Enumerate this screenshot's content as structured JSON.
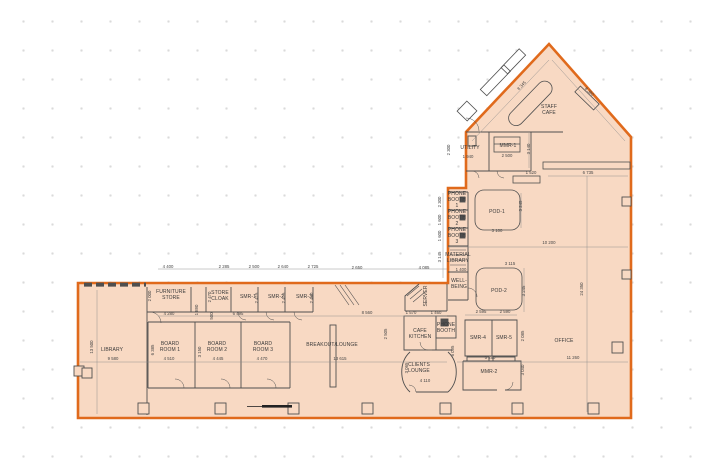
{
  "plan": {
    "title": "office-fitout-floor-plan",
    "colors": {
      "outer_wall": "#e06a1c",
      "floor_fill": "#f8d9c3",
      "partition_line": "#4f4f4f",
      "dim_text": "#474747",
      "grid_dot": "#dadada",
      "background": "#ffffff"
    },
    "rooms": {
      "library": "LIBRARY",
      "board1": "BOARD ROOM 1",
      "board2": "BOARD ROOM 2",
      "board3": "BOARD ROOM 3",
      "breakout": "BREAKOUT/LOUNGE",
      "furniture_store": "FURNITURE STORE",
      "cloak": "STORE CLOAK",
      "smr1": "SMR-1",
      "smr2": "SMR-2",
      "smr3": "SMR-3",
      "server": "SERVER",
      "kitchen": "CAFE KITCHEN",
      "phone_booth": "PHONE BOOTH",
      "clients": "CLIENTS LOUNGE",
      "smr4": "SMR-4",
      "smr5": "SMR-5",
      "mmr2": "MMR-2",
      "office": "OFFICE",
      "staff_cafe": "STAFF CAFE",
      "utility": "UTILITY",
      "mmr1": "MMR-1",
      "pod1": "POD-1",
      "pod2": "POD-2",
      "booth1": "PHONE BOOTH 1",
      "booth2": "PHONE BOOTH 2",
      "booth3": "PHONE BOOTH 3",
      "material_library": "MATERIAL LIBRARY",
      "wellbeing": "WELL-BEING"
    },
    "dims": {
      "furniture_store_w": "4 400",
      "cloak_w": "2 285",
      "smr1_w": "2 500",
      "smr2_w": "2 640",
      "smr3_w": "2 725",
      "entry_w": "2 650",
      "server_w": "4 085",
      "furniture_store_d": "4 280",
      "cloak_d": "500",
      "cloak_block_w": "6 495",
      "breakout_top_w": "8 560",
      "kitchen_w1": "1 570",
      "kitchen_w2": "1 460",
      "library_w": "9 580",
      "board1_w": "4 510",
      "board2_w": "4 445",
      "board3_w": "4 470",
      "breakout_w": "13 615",
      "mmr2_w": "5 280",
      "office_w": "11 260",
      "clients_w": "4 110",
      "office_top_w": "10 200",
      "shelf_w": "6 735",
      "shelf2_w": "1 520",
      "pod1_w": "3 100",
      "pod2_w": "3 115",
      "mmr1_w": "2 500",
      "utility_w": "1 940",
      "wellbeing_w": "1 400",
      "smr4_w": "2 595",
      "smr5_w": "2 590",
      "library_h": "13 500",
      "board1_h": "6 385",
      "board2_h": "3 150",
      "furniture_store_h": "2 000",
      "cloak_h": "2 470",
      "lobby_h": "1 890",
      "smr1_h": "2 415",
      "smr2_h": "2 415",
      "smr3_h": "2 440",
      "kitchen_h": "2 505",
      "clients_h": "3 065",
      "smr_block_h": "6 095",
      "smr5_h": "2 085",
      "mmr2_h": "3 040",
      "office_h": "24 350",
      "mmr1_h": "3 140",
      "utility_h": "2 300",
      "booth1_h": "2 300",
      "booth2_h": "1 600",
      "booth3_h": "1 600",
      "matlib_h": "3 145",
      "pod1_h": "3 245",
      "pod2_h": "3 245",
      "cafe_slope_left": "8 345",
      "cafe_slope_right": "8 380"
    }
  }
}
